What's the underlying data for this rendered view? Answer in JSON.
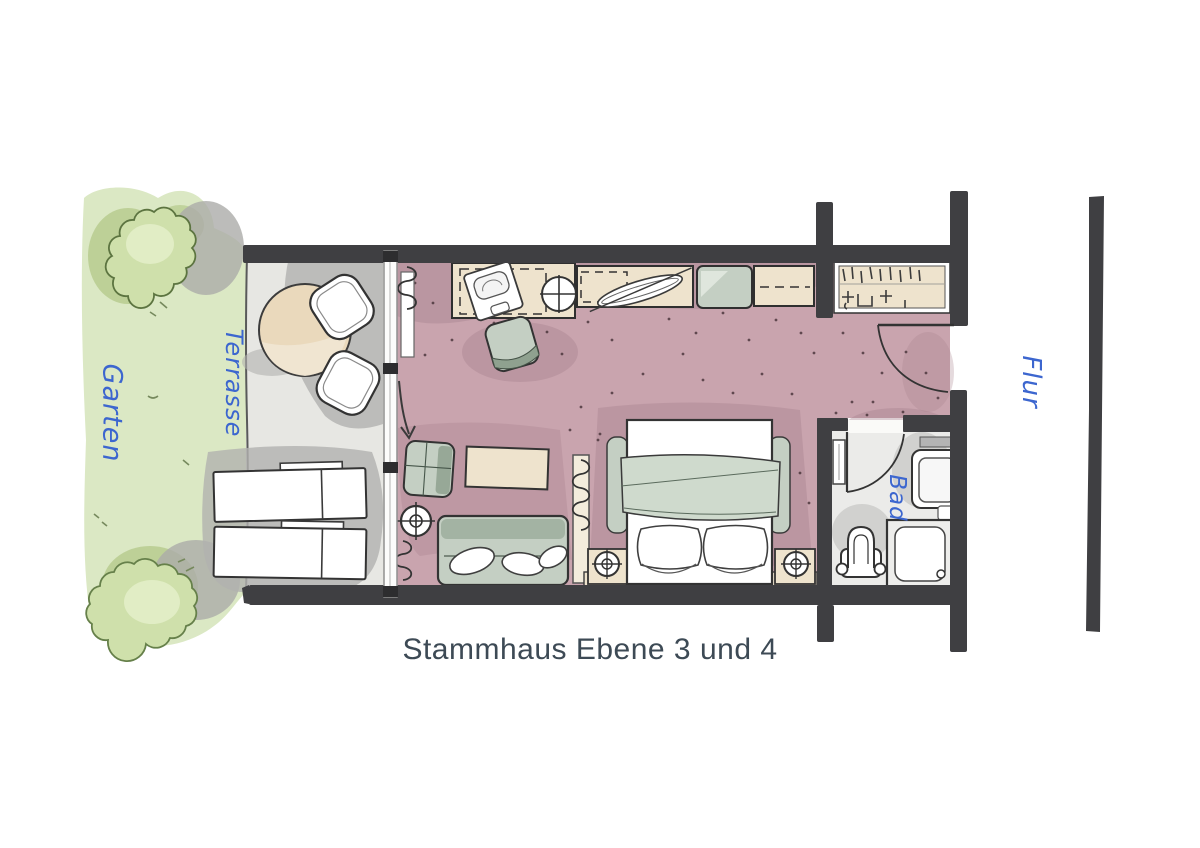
{
  "title": "Stammhaus Ebene 3 und 4",
  "labels": {
    "garden": "Garten",
    "terrace": "Terrasse",
    "hallway": "Flur",
    "bathroom": "Bad"
  },
  "icons": {
    "radiator": "squiggle-coil",
    "lamp": "circle-crosshair",
    "door-swing": "quarter-arc",
    "entry-direction": "down-arrow"
  },
  "colors": {
    "wall": "#3f3f42",
    "room-floor": "#c9a4ae",
    "room-shadow": "#a8838f",
    "terrace-floor": "#e7e7e3",
    "shadow-gray": "#b2b2af",
    "furniture-beige": "#eee3cd",
    "furniture-sage": "#c4cfc3",
    "garden-light": "#dbe8c4",
    "garden-bush": "#cfe0ab",
    "bath-floor": "#ebebe9",
    "label-blue": "#3c66cf",
    "title-text": "#3d4a55",
    "outline": "#333333"
  }
}
